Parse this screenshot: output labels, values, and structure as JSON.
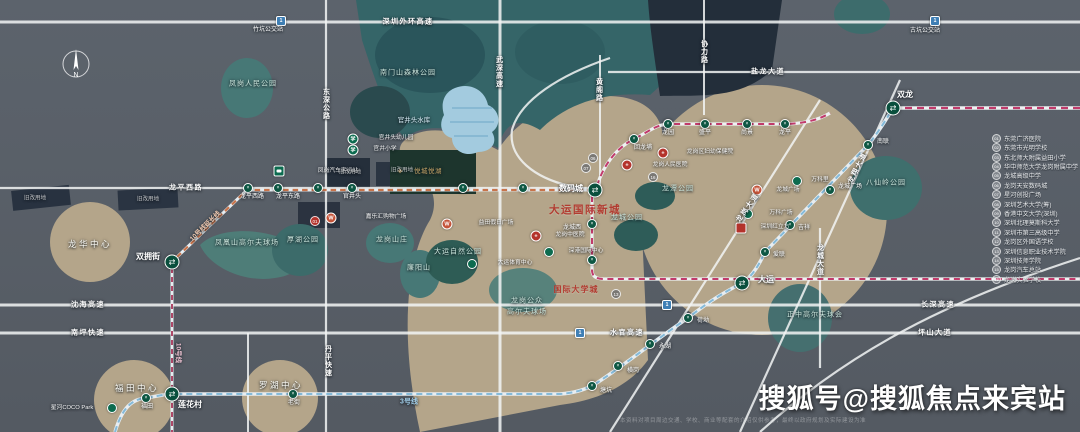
{
  "watermark": "搜狐号@搜狐焦点来宾站",
  "disclaimer": "本资料对项目周边交通、学校、商业等配套的介绍仅供参考，最终以政府规划及实际建设为准",
  "compass": {
    "label": "N"
  },
  "colors": {
    "background": "#5a6169",
    "land": "#b4a58a",
    "forest": "#356568",
    "park": "#477876",
    "water": "#a3cbdf",
    "road": "#f2f4f4",
    "line3": "#84bad9",
    "line16": "#c13a6b",
    "line10": "#ad4868",
    "line10ext": "#c8744b",
    "station": "#0d5743",
    "title_red": "#b23c31"
  },
  "map": {
    "labels": [
      {
        "t": "深圳外环高速",
        "x": 408,
        "y": 22,
        "c": "lbl-road",
        "n": "road-label"
      },
      {
        "t": "盐龙大道",
        "x": 768,
        "y": 72,
        "c": "lbl-road",
        "n": "road-label"
      },
      {
        "t": "龙平西路",
        "x": 186,
        "y": 188,
        "c": "lbl-road",
        "n": "road-label"
      },
      {
        "t": "沈海高速",
        "x": 88,
        "y": 305,
        "c": "lbl-road",
        "n": "road-label"
      },
      {
        "t": "长深高速",
        "x": 938,
        "y": 305,
        "c": "lbl-road",
        "n": "road-label"
      },
      {
        "t": "南坪快速",
        "x": 88,
        "y": 333,
        "c": "lbl-road",
        "n": "road-label"
      },
      {
        "t": "水官高速",
        "x": 627,
        "y": 333,
        "c": "lbl-road",
        "n": "road-label"
      },
      {
        "t": "坪山大道",
        "x": 935,
        "y": 333,
        "c": "lbl-road",
        "n": "road-label"
      },
      {
        "t": "东深公路",
        "x": 326,
        "y": 104,
        "c": "lbl-roadv",
        "n": "road-label"
      },
      {
        "t": "武深高速",
        "x": 499,
        "y": 72,
        "c": "lbl-roadv",
        "n": "road-label"
      },
      {
        "t": "黄阁路",
        "x": 599,
        "y": 90,
        "c": "lbl-roadv",
        "n": "road-label"
      },
      {
        "t": "协力路",
        "x": 704,
        "y": 52,
        "c": "lbl-roadv",
        "n": "road-label"
      },
      {
        "t": "丹平快速",
        "x": 328,
        "y": 361,
        "c": "lbl-roadv",
        "n": "road-label"
      },
      {
        "t": "龙城大道",
        "x": 820,
        "y": 260,
        "c": "lbl-roadv",
        "n": "road-label"
      },
      {
        "t": "龙岗大道",
        "x": 748,
        "y": 208,
        "c": "lbl-road",
        "r": -55,
        "n": "road-label"
      },
      {
        "t": "龙翔大道",
        "x": 858,
        "y": 168,
        "c": "lbl-road",
        "r": -63,
        "n": "road-label"
      },
      {
        "t": "3号线",
        "x": 409,
        "y": 402,
        "c": "lbl-line3",
        "n": "metro-line-label"
      },
      {
        "t": "10号线",
        "x": 177,
        "y": 353,
        "c": "lbl-line10",
        "r": 90,
        "n": "metro-line-label"
      },
      {
        "t": "10号线延长线",
        "x": 206,
        "y": 227,
        "c": "lbl-line10o",
        "r": -44,
        "n": "metro-line-label"
      },
      {
        "t": "凤岗人民公园",
        "x": 253,
        "y": 84,
        "c": "lbl-park",
        "n": "park-label"
      },
      {
        "t": "南门山森林公园",
        "x": 408,
        "y": 73,
        "c": "lbl-park",
        "n": "park-label"
      },
      {
        "t": "官井头水库",
        "x": 414,
        "y": 121,
        "c": "lbl-water",
        "n": "water-label"
      },
      {
        "t": "凤凰山高尔夫球场",
        "x": 247,
        "y": 243,
        "c": "lbl-park",
        "n": "park-label"
      },
      {
        "t": "厚湖公园",
        "x": 303,
        "y": 240,
        "c": "lbl-park",
        "n": "park-label"
      },
      {
        "t": "龙岗山庄",
        "x": 392,
        "y": 240,
        "c": "lbl-park",
        "n": "park-label"
      },
      {
        "t": "廉阳山",
        "x": 419,
        "y": 268,
        "c": "lbl-park",
        "n": "park-label"
      },
      {
        "t": "大运自然公园",
        "x": 458,
        "y": 252,
        "c": "lbl-park",
        "n": "park-label"
      },
      {
        "t": "龙岗公众",
        "x": 527,
        "y": 301,
        "c": "lbl-park",
        "n": "park-label"
      },
      {
        "t": "高尔夫球场",
        "x": 527,
        "y": 312,
        "c": "lbl-park",
        "n": "park-label"
      },
      {
        "t": "龙潭公园",
        "x": 678,
        "y": 189,
        "c": "lbl-park",
        "n": "park-label"
      },
      {
        "t": "龙城公园",
        "x": 627,
        "y": 218,
        "c": "lbl-park",
        "n": "park-label"
      },
      {
        "t": "八仙岭公园",
        "x": 886,
        "y": 183,
        "c": "lbl-park",
        "n": "park-label"
      },
      {
        "t": "正中高尔夫球会",
        "x": 815,
        "y": 315,
        "c": "lbl-park",
        "n": "park-label"
      },
      {
        "t": "龙华中心",
        "x": 90,
        "y": 244,
        "c": "lbl-district",
        "n": "district-label"
      },
      {
        "t": "福田中心",
        "x": 137,
        "y": 388,
        "c": "lbl-district",
        "n": "district-label"
      },
      {
        "t": "罗湖中心",
        "x": 281,
        "y": 385,
        "c": "lbl-district",
        "n": "district-label"
      },
      {
        "t": "大运国际新城",
        "x": 585,
        "y": 210,
        "c": "lbl-title",
        "n": "project-title"
      },
      {
        "t": "国际大学城",
        "x": 576,
        "y": 290,
        "c": "lbl-sub",
        "n": "area-title"
      },
      {
        "t": "悦城悦湖",
        "x": 428,
        "y": 172,
        "c": "lbl-gold",
        "n": "project-logo-label"
      },
      {
        "t": "双龙",
        "x": 905,
        "y": 95,
        "c": "lbl-stb",
        "n": "station-label"
      },
      {
        "t": "大运",
        "x": 766,
        "y": 280,
        "c": "lbl-stb",
        "n": "station-label"
      },
      {
        "t": "数码城",
        "x": 571,
        "y": 189,
        "c": "lbl-stb",
        "n": "station-label"
      },
      {
        "t": "双拥街",
        "x": 148,
        "y": 257,
        "c": "lbl-stb",
        "n": "station-label"
      },
      {
        "t": "莲花村",
        "x": 190,
        "y": 405,
        "c": "lbl-stb",
        "n": "station-label"
      },
      {
        "t": "福田",
        "x": 147,
        "y": 407,
        "c": "lbl-sts",
        "n": "station-label"
      },
      {
        "t": "老街",
        "x": 294,
        "y": 403,
        "c": "lbl-sts",
        "n": "station-label"
      },
      {
        "t": "塘坑",
        "x": 606,
        "y": 391,
        "c": "lbl-sts",
        "n": "station-label"
      },
      {
        "t": "横岗",
        "x": 633,
        "y": 371,
        "c": "lbl-sts",
        "n": "station-label"
      },
      {
        "t": "永湖",
        "x": 665,
        "y": 347,
        "c": "lbl-sts",
        "n": "station-label"
      },
      {
        "t": "荷坳",
        "x": 703,
        "y": 321,
        "c": "lbl-sts",
        "n": "station-label"
      },
      {
        "t": "爱联",
        "x": 779,
        "y": 255,
        "c": "lbl-sts",
        "n": "station-label"
      },
      {
        "t": "吉祥",
        "x": 804,
        "y": 228,
        "c": "lbl-sts",
        "n": "station-label"
      },
      {
        "t": "龙城广场",
        "x": 850,
        "y": 187,
        "c": "lbl-sts",
        "n": "station-label"
      },
      {
        "t": "南联",
        "x": 883,
        "y": 142,
        "c": "lbl-sts",
        "n": "station-label"
      },
      {
        "t": "回龙埔",
        "x": 643,
        "y": 148,
        "c": "lbl-sts",
        "n": "station-label"
      },
      {
        "t": "龙园",
        "x": 668,
        "y": 133,
        "c": "lbl-sts",
        "n": "station-label"
      },
      {
        "t": "盛平",
        "x": 705,
        "y": 133,
        "c": "lbl-sts",
        "n": "station-label"
      },
      {
        "t": "尚景",
        "x": 747,
        "y": 133,
        "c": "lbl-sts",
        "n": "station-label"
      },
      {
        "t": "龙平",
        "x": 785,
        "y": 133,
        "c": "lbl-sts",
        "n": "station-label"
      },
      {
        "t": "龙城西",
        "x": 572,
        "y": 228,
        "c": "lbl-sts",
        "n": "station-label"
      },
      {
        "t": "龙平西路",
        "x": 252,
        "y": 197,
        "c": "lbl-sts",
        "n": "station-label"
      },
      {
        "t": "龙平东路",
        "x": 288,
        "y": 197,
        "c": "lbl-sts",
        "n": "station-label"
      },
      {
        "t": "官井头",
        "x": 352,
        "y": 197,
        "c": "lbl-sts",
        "n": "station-label"
      },
      {
        "t": "竹坑公交站",
        "x": 268,
        "y": 30,
        "c": "lbl-sts",
        "n": "bus-stop-label"
      },
      {
        "t": "古坑公交站",
        "x": 925,
        "y": 31,
        "c": "lbl-sts",
        "n": "bus-stop-label"
      },
      {
        "t": "凤岗汽车客运站",
        "x": 338,
        "y": 172,
        "c": "lbl-poi",
        "n": "poi-label"
      },
      {
        "t": "嘉乐汇购物广场",
        "x": 386,
        "y": 218,
        "c": "lbl-poi",
        "n": "poi-label"
      },
      {
        "t": "益田假日广场",
        "x": 496,
        "y": 224,
        "c": "lbl-poi",
        "n": "poi-label"
      },
      {
        "t": "龙岗人民医院",
        "x": 670,
        "y": 166,
        "c": "lbl-poi",
        "n": "poi-label"
      },
      {
        "t": "龙岗区妇幼保健院",
        "x": 710,
        "y": 153,
        "c": "lbl-poi",
        "n": "poi-label"
      },
      {
        "t": "龙岗中医院",
        "x": 570,
        "y": 236,
        "c": "lbl-poi",
        "n": "poi-label"
      },
      {
        "t": "深圳红立方",
        "x": 775,
        "y": 228,
        "c": "lbl-poi",
        "n": "poi-label"
      },
      {
        "t": "大运体育中心",
        "x": 515,
        "y": 264,
        "c": "lbl-poi",
        "n": "poi-label"
      },
      {
        "t": "深港国际中心",
        "x": 586,
        "y": 252,
        "c": "lbl-poi",
        "n": "poi-label"
      },
      {
        "t": "龙城广场",
        "x": 788,
        "y": 191,
        "c": "lbl-poi",
        "n": "poi-label"
      },
      {
        "t": "万科里",
        "x": 820,
        "y": 181,
        "c": "lbl-poi",
        "n": "poi-label"
      },
      {
        "t": "万科广场",
        "x": 781,
        "y": 214,
        "c": "lbl-poi",
        "n": "poi-label"
      },
      {
        "t": "官井头幼儿园",
        "x": 396,
        "y": 139,
        "c": "lbl-poi",
        "n": "poi-label"
      },
      {
        "t": "官井小学",
        "x": 385,
        "y": 150,
        "c": "lbl-poi",
        "n": "poi-label"
      },
      {
        "t": "星河COCO Park",
        "x": 72,
        "y": 409,
        "c": "lbl-poi",
        "n": "poi-label"
      },
      {
        "t": "旧改用地",
        "x": 35,
        "y": 199,
        "c": "lbl-redev",
        "n": "redevelopment-label"
      },
      {
        "t": "旧改用地",
        "x": 148,
        "y": 200,
        "c": "lbl-redev",
        "n": "redevelopment-label"
      },
      {
        "t": "旧改用地",
        "x": 350,
        "y": 173,
        "c": "lbl-redev",
        "n": "redevelopment-label"
      },
      {
        "t": "旧改用地",
        "x": 402,
        "y": 171,
        "c": "lbl-redev",
        "n": "redevelopment-label"
      }
    ],
    "stations": [
      {
        "n": "双拥街",
        "x": 172,
        "y": 262,
        "t": "x"
      },
      {
        "n": "莲花村",
        "x": 172,
        "y": 394,
        "t": "x"
      },
      {
        "n": "数码城",
        "x": 595,
        "y": 190,
        "t": "x"
      },
      {
        "n": "大运",
        "x": 742,
        "y": 283,
        "t": "x"
      },
      {
        "n": "双龙",
        "x": 893,
        "y": 108,
        "t": "x"
      },
      {
        "n": "福田",
        "x": 146,
        "y": 398,
        "t": "s"
      },
      {
        "n": "老街",
        "x": 293,
        "y": 394,
        "t": "s"
      },
      {
        "n": "塘坑",
        "x": 592,
        "y": 386,
        "t": "s"
      },
      {
        "n": "横岗",
        "x": 618,
        "y": 366,
        "t": "s"
      },
      {
        "n": "永湖",
        "x": 650,
        "y": 344,
        "t": "s"
      },
      {
        "n": "荷坳",
        "x": 688,
        "y": 318,
        "t": "s"
      },
      {
        "n": "爱联",
        "x": 765,
        "y": 252,
        "t": "s"
      },
      {
        "n": "吉祥",
        "x": 790,
        "y": 225,
        "t": "s"
      },
      {
        "n": "龙城广场",
        "x": 830,
        "y": 190,
        "t": "s"
      },
      {
        "n": "南联",
        "x": 868,
        "y": 145,
        "t": "s"
      },
      {
        "n": "回龙埔",
        "x": 634,
        "y": 139,
        "t": "s"
      },
      {
        "n": "龙园",
        "x": 668,
        "y": 124,
        "t": "s"
      },
      {
        "n": "盛平",
        "x": 705,
        "y": 124,
        "t": "s"
      },
      {
        "n": "尚景",
        "x": 747,
        "y": 124,
        "t": "s"
      },
      {
        "n": "龙平",
        "x": 785,
        "y": 124,
        "t": "s"
      },
      {
        "n": "龙城西",
        "x": 592,
        "y": 224,
        "t": "s"
      },
      {
        "n": "站",
        "x": 592,
        "y": 260,
        "t": "s"
      },
      {
        "n": "龙平西路",
        "x": 248,
        "y": 188,
        "t": "s"
      },
      {
        "n": "龙平东路",
        "x": 278,
        "y": 188,
        "t": "s"
      },
      {
        "n": "站",
        "x": 318,
        "y": 188,
        "t": "s"
      },
      {
        "n": "官井头",
        "x": 352,
        "y": 188,
        "t": "s"
      },
      {
        "n": "站",
        "x": 463,
        "y": 188,
        "t": "s"
      },
      {
        "n": "站",
        "x": 523,
        "y": 188,
        "t": "s"
      }
    ],
    "badges": [
      {
        "type": "bus",
        "x": 279,
        "y": 171,
        "n": "bus-station-icon"
      },
      {
        "type": "hwy",
        "x": 281,
        "y": 21,
        "n": "highway-entrance-icon"
      },
      {
        "type": "hwy",
        "x": 935,
        "y": 21,
        "n": "highway-entrance-icon"
      },
      {
        "type": "hwy",
        "x": 667,
        "y": 305,
        "n": "highway-entrance-icon"
      },
      {
        "type": "hwy",
        "x": 580,
        "y": 333,
        "n": "highway-entrance-icon"
      },
      {
        "type": "school",
        "x": 353,
        "y": 139,
        "n": "school-icon"
      },
      {
        "type": "school",
        "x": 353,
        "y": 150,
        "n": "school-icon"
      },
      {
        "type": "mall",
        "x": 331,
        "y": 218,
        "n": "mall-icon"
      },
      {
        "type": "mall",
        "x": 447,
        "y": 224,
        "n": "mall-icon"
      },
      {
        "type": "mall",
        "x": 757,
        "y": 190,
        "n": "mall-icon"
      },
      {
        "type": "hosp",
        "x": 627,
        "y": 165,
        "n": "hospital-icon"
      },
      {
        "type": "hosp",
        "x": 663,
        "y": 153,
        "n": "hospital-icon"
      },
      {
        "type": "hosp",
        "x": 536,
        "y": 236,
        "n": "hospital-icon"
      },
      {
        "type": "cube",
        "x": 741,
        "y": 228,
        "n": "landmark-icon"
      },
      {
        "type": "poi",
        "x": 472,
        "y": 264,
        "n": "poi-icon"
      },
      {
        "type": "poi",
        "x": 549,
        "y": 252,
        "n": "poi-icon"
      },
      {
        "type": "poi",
        "x": 797,
        "y": 181,
        "n": "poi-icon"
      },
      {
        "type": "poi",
        "x": 748,
        "y": 214,
        "n": "poi-icon"
      },
      {
        "type": "poi",
        "x": 112,
        "y": 408,
        "n": "poi-icon"
      },
      {
        "type": "logo",
        "x": 400,
        "y": 171,
        "n": "project-logo-icon"
      }
    ],
    "badge_glyphs": {
      "school": "学",
      "mall": "W",
      "hosp": "+",
      "hwy": "1",
      "logo": "◆"
    },
    "numbers": [
      {
        "n": "01",
        "x": 315,
        "y": 221,
        "red": true
      },
      {
        "n": "06",
        "x": 593,
        "y": 158
      },
      {
        "n": "07",
        "x": 586,
        "y": 168
      },
      {
        "n": "16",
        "x": 653,
        "y": 177
      },
      {
        "n": "13",
        "x": 616,
        "y": 294
      }
    ]
  },
  "sidebar": {
    "items": [
      "东莞广济医院",
      "东莞市光明学校",
      "东北师大附属益田小学",
      "华中师范大学龙岗附属中学",
      "龙城高级中学",
      "龙岗天安数码城",
      "星河创投广场",
      "深圳艺术大学(筹)",
      "香港中文大学(深圳)",
      "深圳北理莫斯科大学",
      "深圳市第三高级中学",
      "龙岗区外国语学校",
      "深圳信息职业技术学院",
      "深圳技师学院",
      "龙岗汽车总站",
      "龙岗实验学校"
    ]
  }
}
